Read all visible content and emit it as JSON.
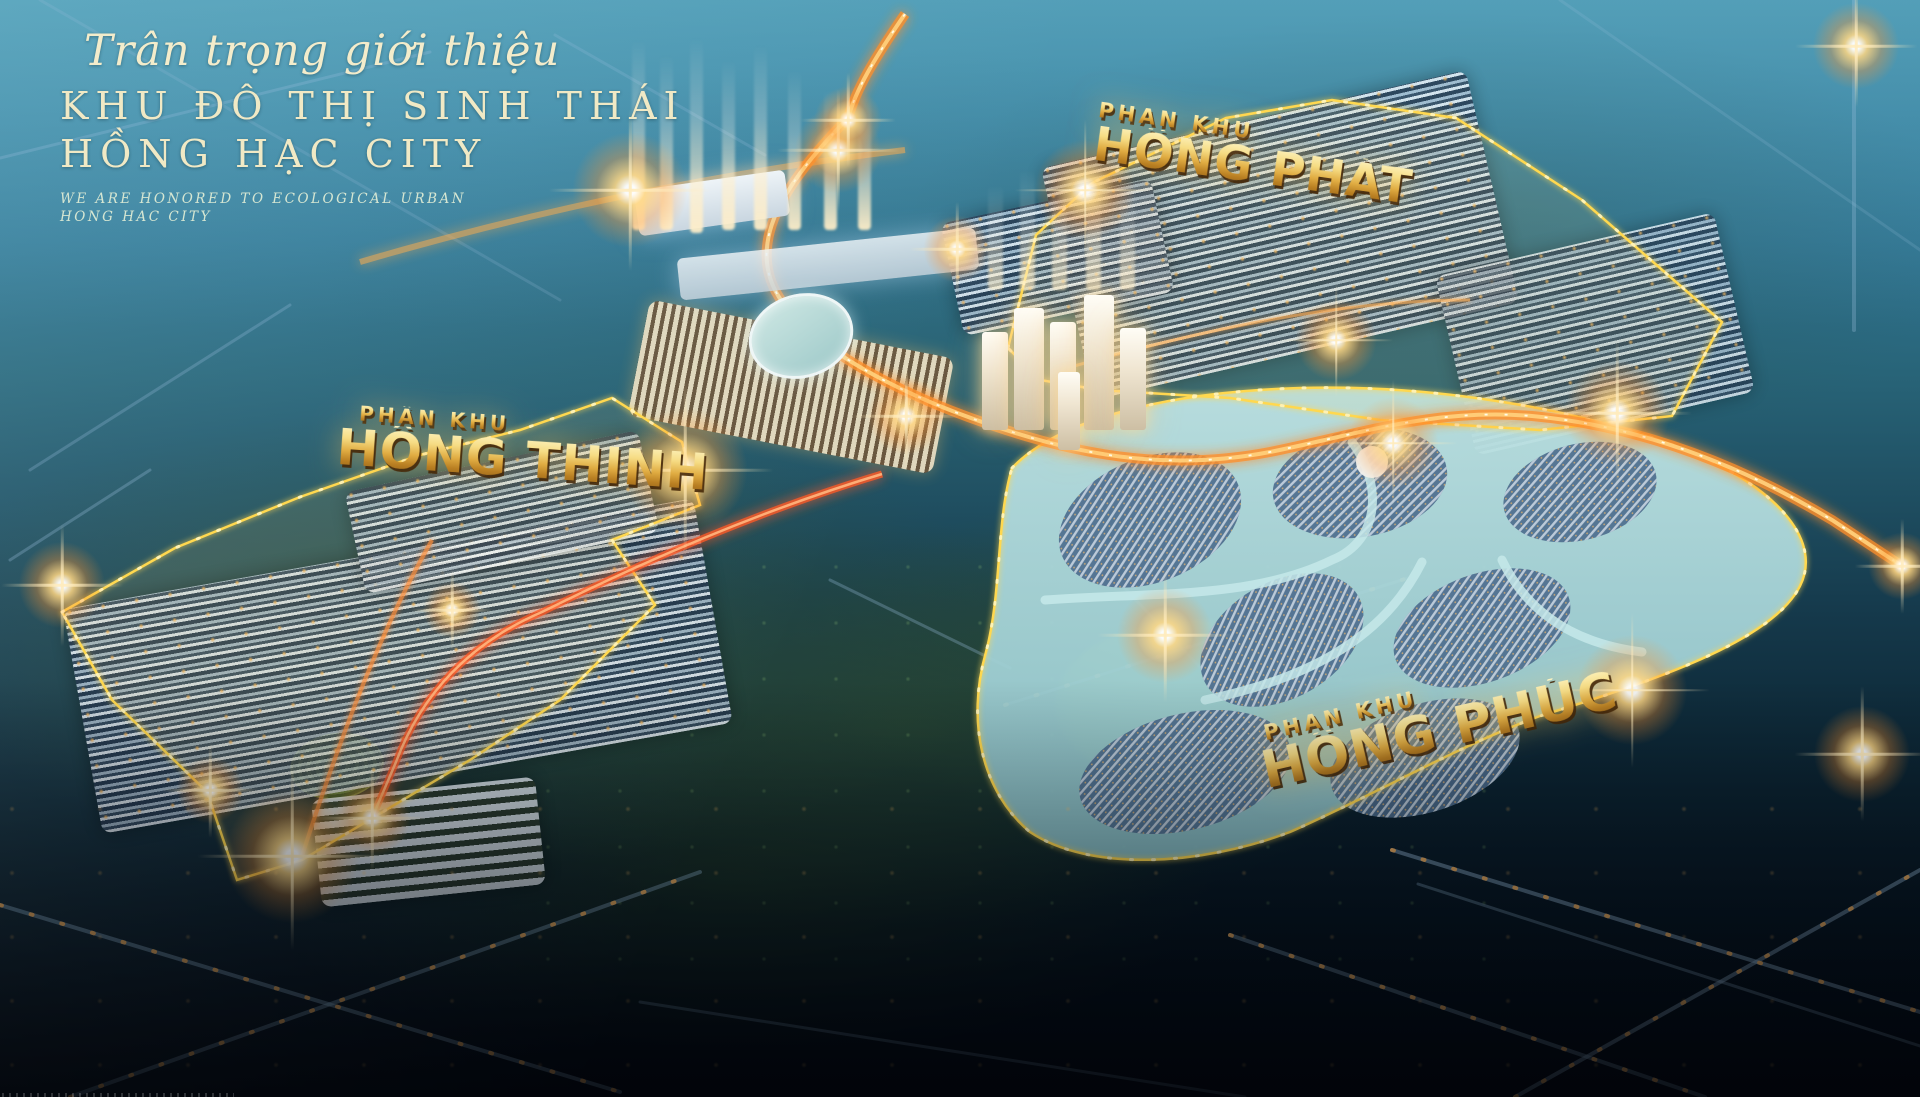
{
  "page": {
    "title": "Hồng Hạc City Masterplan"
  },
  "title_block": {
    "script_line": "Trân trọng giới thiệu",
    "heading_line1": "KHU ĐÔ THỊ SINH THÁI",
    "heading_line2": "HỒNG HẠC CITY",
    "subtitle_line1": "WE ARE HONORED TO ECOLOGICAL URBAN",
    "subtitle_line2": "HONG HAC CITY"
  },
  "zones": [
    {
      "prefix": "PHÂN KHU",
      "name": "HỒNG PHÁT"
    },
    {
      "prefix": "PHÂN KHU",
      "name": "HỒNG THINH"
    },
    {
      "prefix": "PHÂN KHU",
      "name": "HỒNG PHÚC"
    }
  ],
  "colors": {
    "title_cream": "#f1ebc8",
    "label_gold": "#e8b84a",
    "boundary_yellow": "#ffd84f",
    "artery_orange": "#ff8f2a",
    "sky_teal": "#3a84a2",
    "night_navy": "#050f1a"
  }
}
